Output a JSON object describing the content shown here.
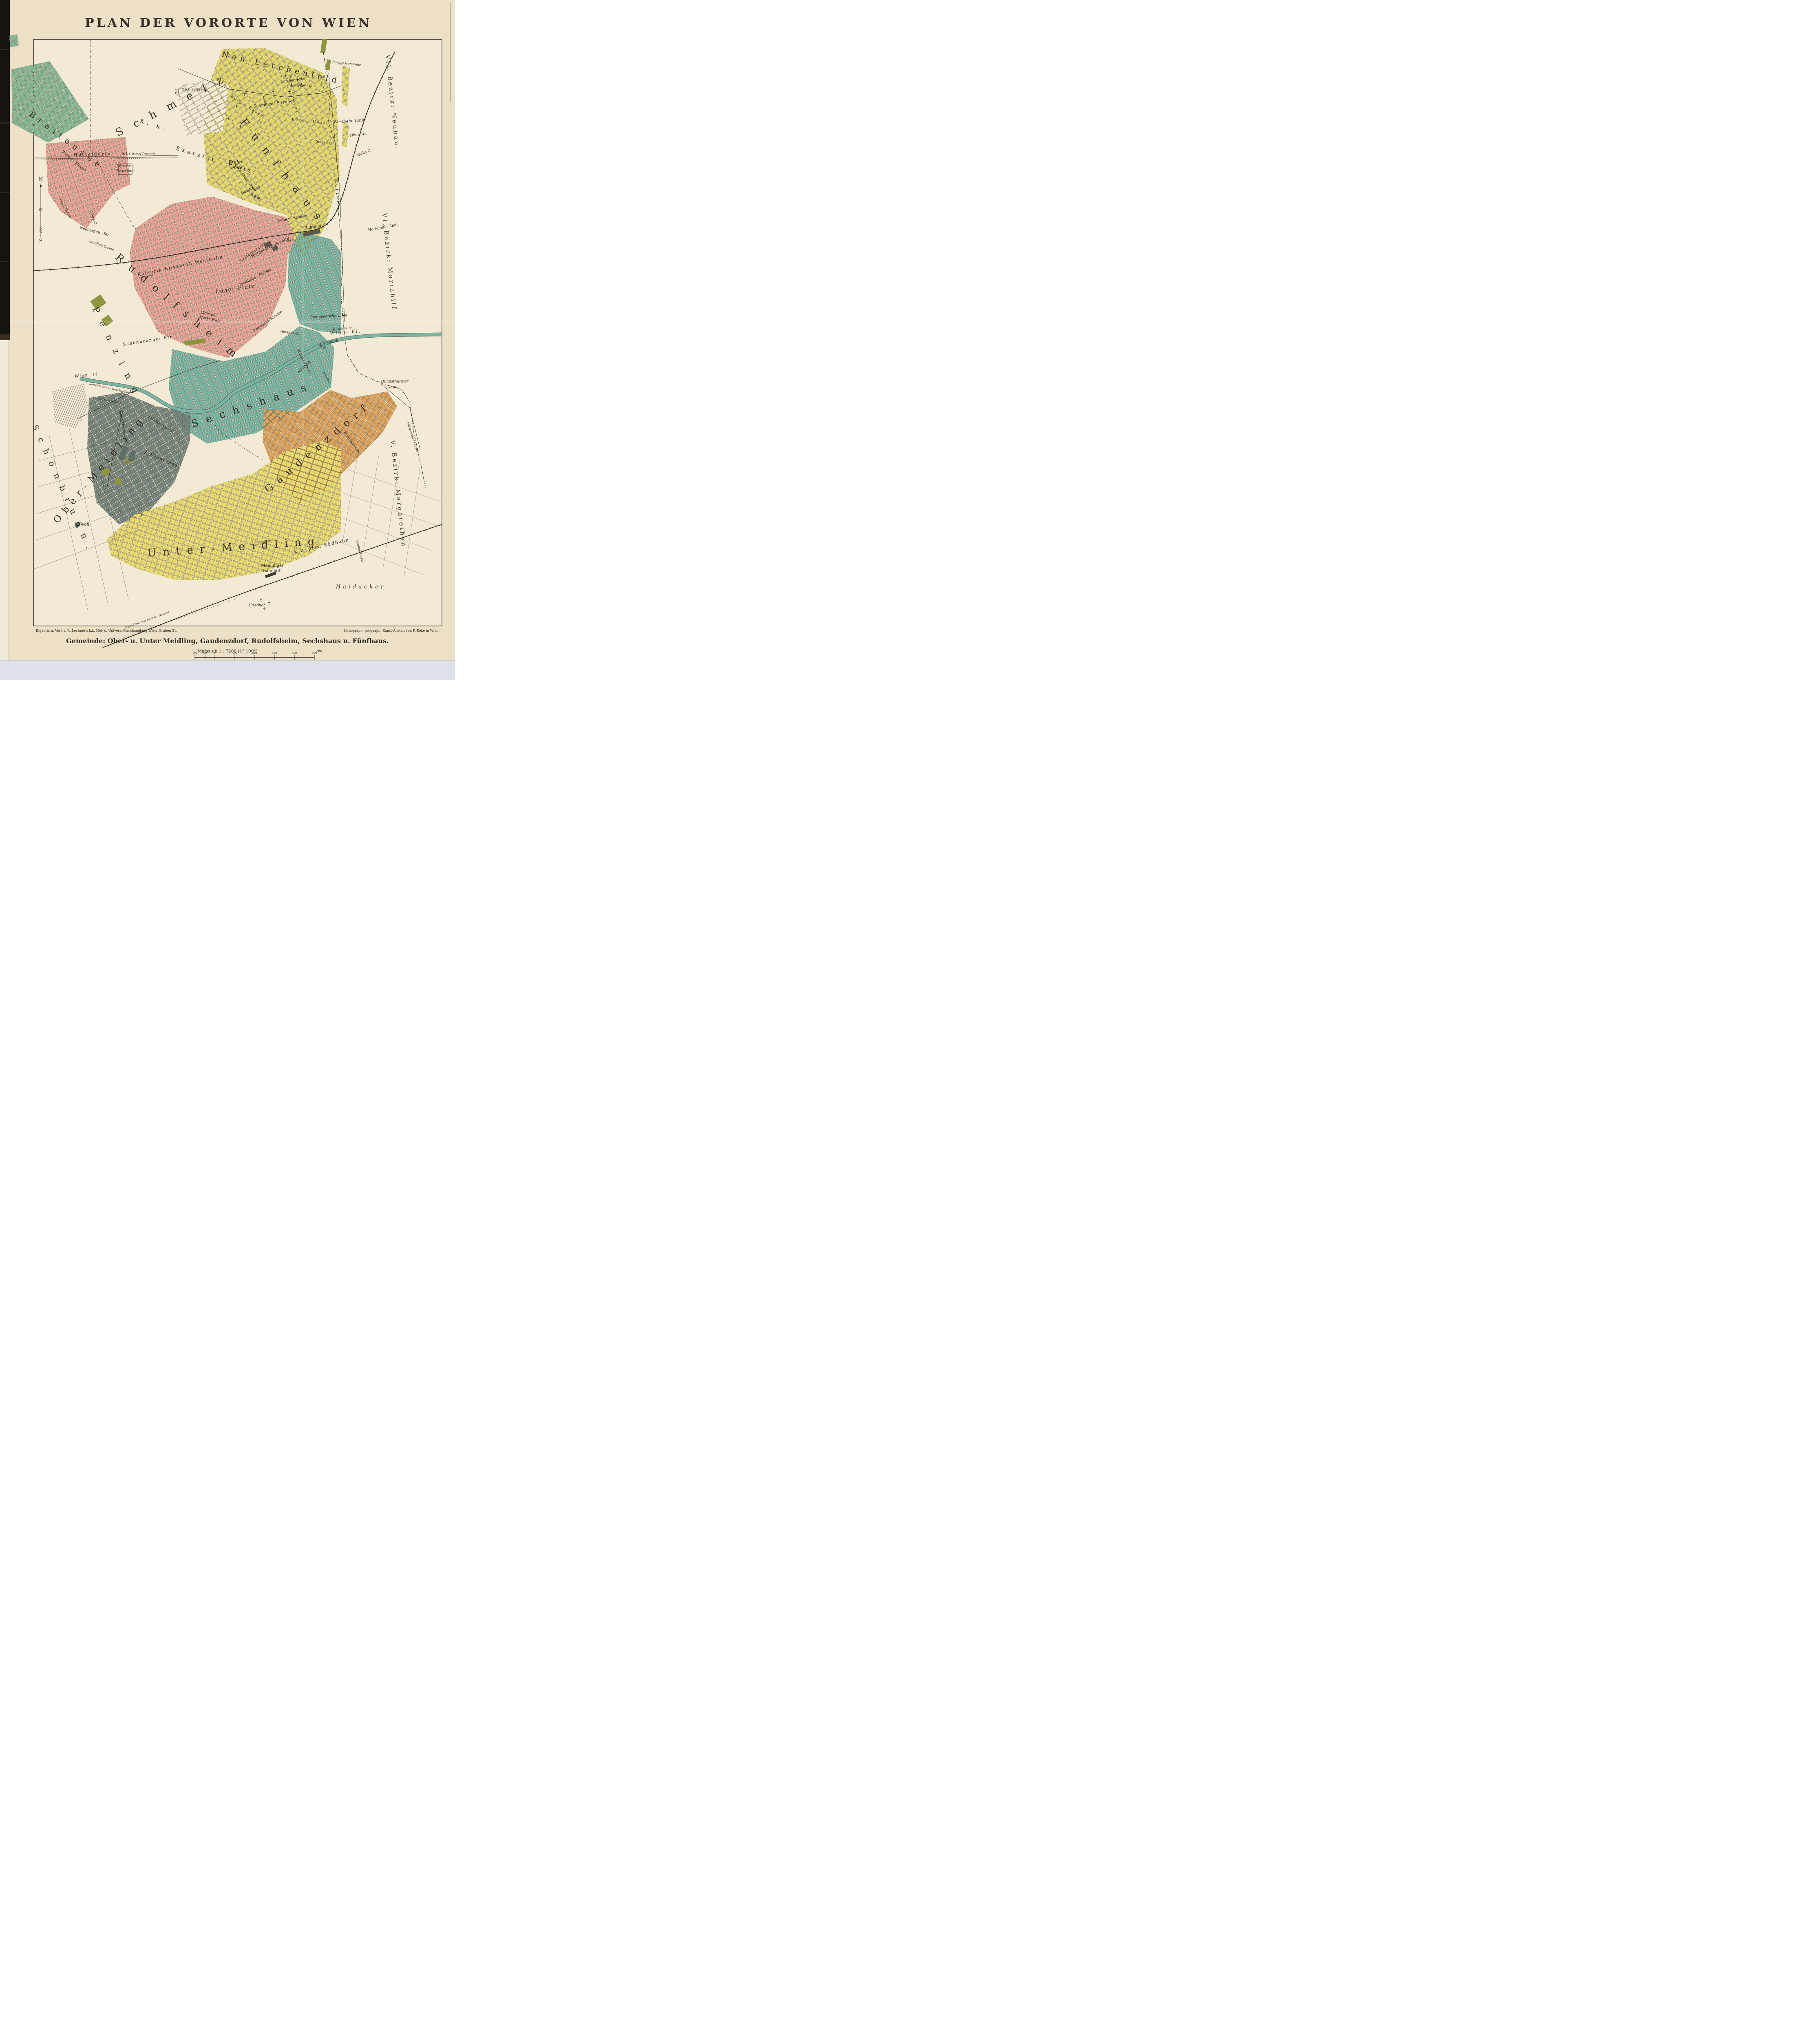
{
  "title": "PLAN DER VORORTE VON WIEN",
  "imprint": {
    "left": "Eigenth. u. Verl. v. R. Lechner's k.k. Hof- u. Univers.-Buchhandlung Wien, Graben 31.",
    "right": "Lithograph.-geograph. Kunst-Anstalt von F. Köke in Wien."
  },
  "caption": {
    "gemeinde": "Gemeinde:  Ober- u. Unter Meidling, Gaudenzdorf, Rudolfsheim, Sechshaus u. Fünfhaus.",
    "scale": "Mafsstab  1 : 7200  (1\" 100°)"
  },
  "scale_bar": {
    "unit": "Mtr.",
    "ticks": [
      "100",
      "50",
      "0",
      "100",
      "200",
      "300",
      "400",
      "500"
    ]
  },
  "compass": {
    "north": "N",
    "south": "S"
  },
  "district_labels": {
    "breitensee": "Breitensee",
    "schmelz": "Schmelz",
    "fuenfhaus": "Fünfhaus",
    "rudolfsheim": "Rudolfsheim",
    "sechshaus": "Sechshaus",
    "gaudenzdorf": "Gaudenzdorf",
    "ober_meidling": "Ober-Meidling",
    "unter_meidling": "Unter-Meidling",
    "penzing": "Penzing",
    "schoenbrunn": "Schönbrunn.",
    "neu_lerchenfeld": "Neu-Lerchenfeld",
    "bezirk_vii": "VII. Bezirk: Neubau.",
    "bezirk_vi": "VI. Bezirk: Mariahilf",
    "bezirk_v": "V. Bezirk: Margarethen"
  },
  "labels": {
    "burg_gasse_a": "Burg - Gasse",
    "burg_gasse_b": "Burg - Gasse",
    "burggassen_linie": "Burggassen-Linie",
    "kandl_g": "Kandl G.",
    "westbahn_linie": "Westbahn-Linie",
    "lerchenfelder_friedhof_1": "Lerchenfelder",
    "lerchenfelder_friedhof_2": "Friedhof",
    "schmelzer_friedhof": "Schmelzer Friedhof",
    "reservoir_wl": "Reservoir d. Kais. Ferd. W. L.",
    "seiden_g": "Seiden G.",
    "felber_str": "Felber Str.",
    "apollo_g": "Apollo G.",
    "tischler_kreuz": "Tischler Kreuz",
    "tischler_height": "119",
    "kk": "K. k.",
    "exerzier_platz": "Exerzier - Platz",
    "wasser_1": "Wasser-",
    "wasser_2": "Reservoir",
    "huetteldorfer_str": "Hütteldorfer - Str.",
    "dampf_tramway": "Dampf-Tramway",
    "freier_platz_1": "Freier",
    "freier_platz_2": "Platz.",
    "bahnhof": "Bahnhof",
    "altitude_109": "109.5'",
    "altitude_107": "107'",
    "guertel": "Gürtel",
    "mariahilfer_linie": "Mariahilfer Linie",
    "gumpendorfer_linie": "Gumpendorfer Linie",
    "schlachthaus_br": "Schlachths. Br.",
    "wien_fl_east": "Wien- Fl.",
    "wien_fl_west": "Wien. Fl.",
    "dampf_moedling": "Dampf-Tramway nach Mödling",
    "maria_theresien_br": "Maria-Theresien-Br.",
    "kaiserin_westbahn": "Kaiserin Elisabeth Westbahn",
    "lager_platz": "Lager-Platz",
    "westbahn_werkstaette": "Westbahn-Werkstätte",
    "eisenbahn_strasse": "Eisenbahn Strasse",
    "central_markt_1": "Central-",
    "central_markt_2": "Markt Platz",
    "schoenbrunner_str": "Schönbrunner Str.",
    "schoenbrunner_2": "Schönbrunner",
    "fabriks_gasse": "Fabriks - Gasse",
    "maria_theresia_str": "Maria Theresia Str.",
    "tivoli": "Tivoli",
    "meidlinger_1": "Meidlinger",
    "meidlinger_2": "Bahnhof",
    "suedbahn": "K.k. priv. Südbahn",
    "haidacker": "Haidacker",
    "friedhof_sued": "Friedhof",
    "hundsthurmer_1": "Hundsthurmer",
    "hundsthurmer_2": "Linie",
    "margarethen_guertel": "Margarethen-Gürtel",
    "dampf_neudorf": "Dampf-Tramway nach Wr. Neudorf",
    "haupt_strasse_sechshaus": "Haupt-Strasse",
    "haupt_strasse_gaudenzdorf": "Hauptstrasse",
    "herklotz_g": "Herklotz-G.",
    "muehlbach": "Mühlbach",
    "wienfluss": "Wienfluss",
    "felber_strasse": "Felber - Strasse",
    "lastenstrasse": "Lastenstrasse",
    "westbahn_strasse": "Westbahn - Strasse",
    "goldschlag_gasse": "Goldschlag-Gasse",
    "zink_g": "Zink-G.",
    "sturz_g": "Sturz-G.",
    "neubergen_str": "Neubergen - Str.",
    "lerchen_gasse": "Lerchen-Gasse",
    "flach_gasse": "Flach-Gasse",
    "wiener_strasse": "Wiener - Strasse",
    "rauch_gasse": "Rauch-Gasse",
    "quellen_gasse": "Quellen-Gasse",
    "gas_fabrik_1": "Gas-Fabrik",
    "gas_fabrik_2": "Gas-Fabrik"
  },
  "palette": {
    "paper": "#ece0c6",
    "map_bg": "#f3ead6",
    "ink": "#2b2620",
    "green": "#86b795",
    "pink": "#e8a396",
    "yellow": "#e3d66a",
    "yellow2": "#e8da70",
    "teal": "#78b4a1",
    "orange": "#dfa258",
    "gray": "#75857b",
    "olive": "#8f9440",
    "river": "#7ab4a2",
    "edge_black": "#17130f",
    "scan_strip": "#dde1e8"
  }
}
